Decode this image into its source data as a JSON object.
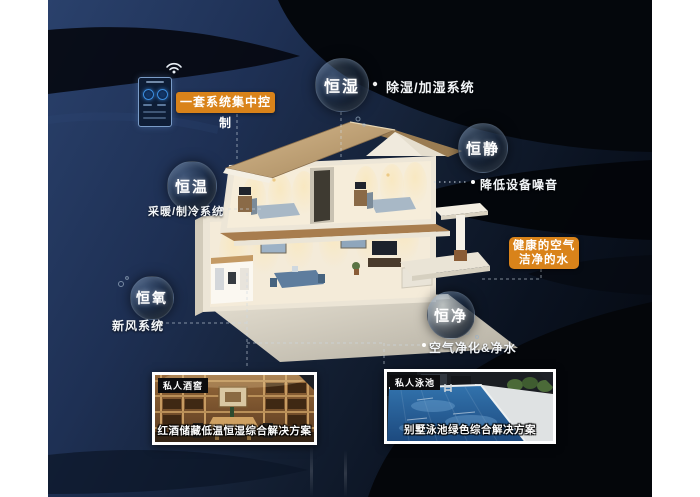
{
  "scene": {
    "control_phone": {
      "label": "一套系统集中控制"
    },
    "bubbles": [
      {
        "label": "恒湿",
        "desc": "除湿/加湿系统"
      },
      {
        "label": "恒静",
        "desc": "降低设备噪音"
      },
      {
        "label": "恒温",
        "desc": "采暖/制冷系统"
      },
      {
        "label": "恒氧",
        "desc": "新风系统"
      },
      {
        "label": "恒净",
        "desc": "空气净化&净水"
      }
    ],
    "highlight": {
      "line1": "健康的空气",
      "line2": "洁净的水"
    },
    "photos": [
      {
        "tag": "私人酒窖",
        "caption": "红酒储藏低温恒湿综合解决方案"
      },
      {
        "tag": "私人泳池",
        "caption": "别墅泳池绿色综合解决方案"
      }
    ],
    "icons": {
      "wifi": "wifi-icon"
    },
    "colors": {
      "accent_orange": "#d9831a",
      "background_navy": "#1e3054",
      "background_dark": "#05080f",
      "bubble_text": "#ffffff",
      "photo_border": "#ffffff"
    }
  }
}
